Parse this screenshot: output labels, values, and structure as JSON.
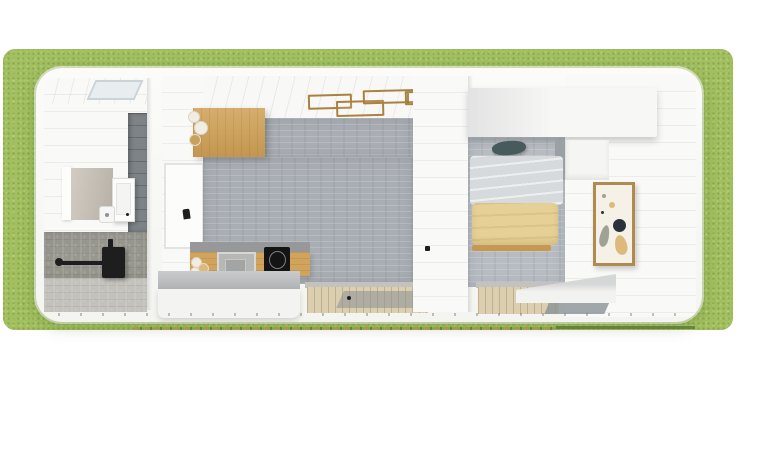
{
  "scene": {
    "type": "tiny-house-floor-plan-top-down-3d-render",
    "rooms": [
      {
        "name": "bathroom",
        "items": [
          "skylight",
          "mirror",
          "medicine-cabinet",
          "sink",
          "towel-bar",
          "wall-hung-black-unit",
          "tile-accent-wall",
          "concrete-vanity",
          "concrete-floor"
        ]
      },
      {
        "name": "kitchen-living",
        "items": [
          "wood-upper-cabinet",
          "decor-vases",
          "wood-ceiling-light-fixture",
          "concrete-floor",
          "counter-with-oven-and-cooktop",
          "counter-jars",
          "white-island",
          "wall-window",
          "glass-door",
          "wood-deck-threshold"
        ]
      },
      {
        "name": "bedroom",
        "items": [
          "overhead-storage-slab",
          "bed",
          "teal-pillow",
          "gray-duvet",
          "yellow-blanket",
          "wood-bed-rail",
          "framed-botanical-art",
          "white-bench",
          "glass-door",
          "wood-deck-threshold"
        ]
      }
    ],
    "surroundings": [
      "grass-lawn",
      "dashed-edge-line",
      "lawn-edge-line"
    ]
  },
  "colors": {
    "grass": "#a2c05f",
    "house_white": "#f8f8f6",
    "wall_white": "#f9f9f7",
    "skylight_gray": "#e8edef",
    "tile_wall": "#7d8387",
    "mirror_tan": "#c3bbb0",
    "mirror_frame_white": "#fdfdfc",
    "cabinet_white": "#fcfcfb",
    "sink_white": "#f6f6f4",
    "fixture_black": "#1e1e1e",
    "vanity_concrete": "#99988f",
    "bath_floor_concrete": "#c2c1bb",
    "wood_cabinet": "#cfa055",
    "wood_light_fixture": "#ab8140",
    "kitchen_floor_gray": "#a9aeb4",
    "counter_top_gray": "#96989a",
    "counter_wood": "#d0a45c",
    "oven_gray": "#b7b8b6",
    "oven_inner_gray": "#a3a5a4",
    "cooktop_black": "#141414",
    "island_top_gray": "#babdbf",
    "island_white": "#f3f3f1",
    "threshold_gray": "#c2c2be",
    "deck_wood": "#dccfb0",
    "glass_gray": "#8a9296",
    "bed_floor_gray": "#b7bcc2",
    "storage_white": "#f7f7f5",
    "pillar_gray": "#9aa0a4",
    "side_cabinet_white": "#f5f5f3",
    "pillow_teal": "#475a5c",
    "duvet_gray": "#d7dadd",
    "blanket_yellow": "#e6d096",
    "bed_rail_wood": "#c79851",
    "bench_white": "#f2f2f0",
    "art_frame_wood": "#b18a50",
    "art_canvas": "#f6f1e6",
    "art_dark_navy": "#2b313d",
    "art_tan": "#ddba7c",
    "art_leaf_gray": "#9fa295",
    "vase_white": "#f2ede4",
    "vase_tan": "#c9a05c",
    "lawn_edge_olive": "#5f7d37"
  }
}
